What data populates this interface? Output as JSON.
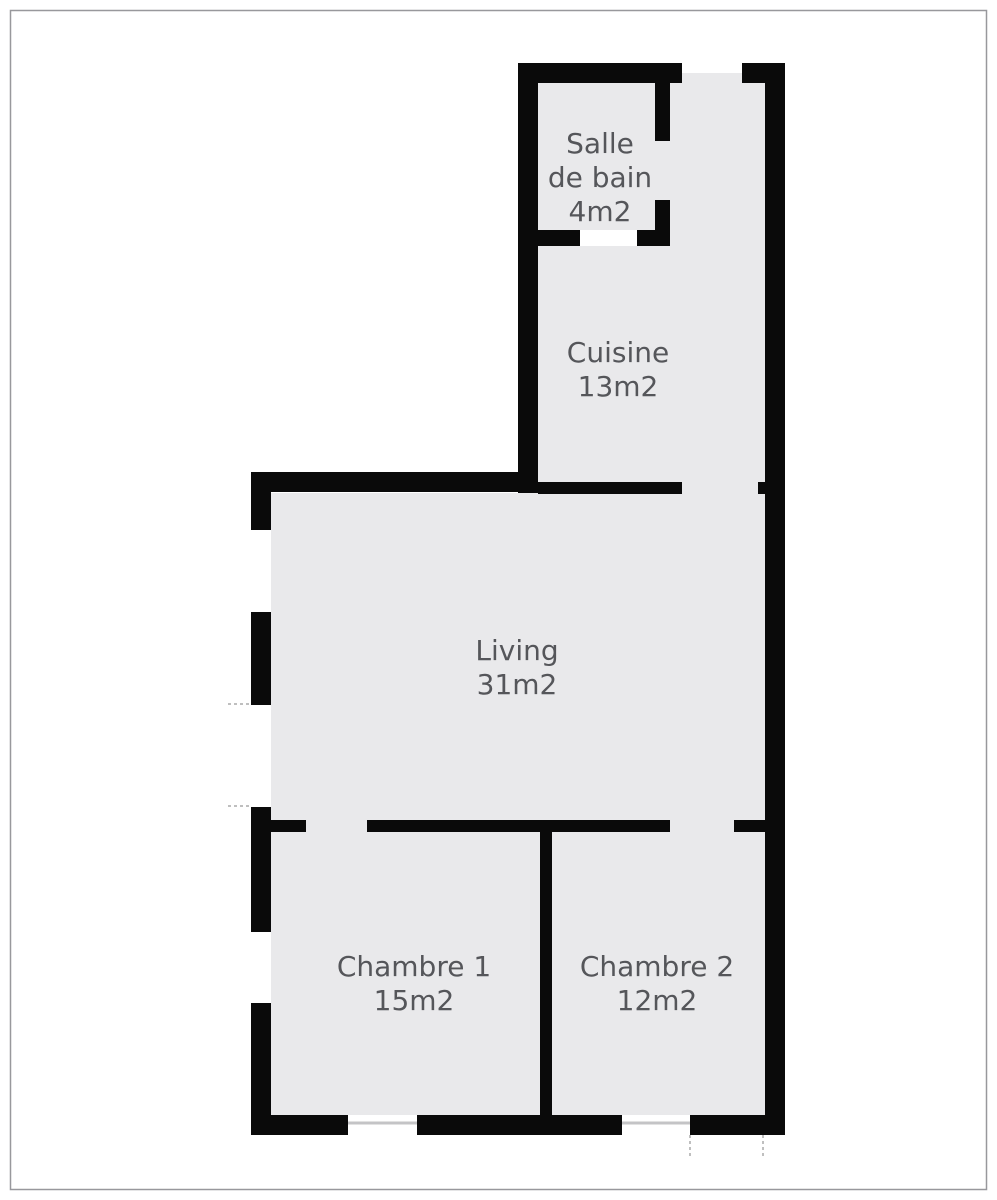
{
  "plan": {
    "type": "apartment-floor-plan",
    "rooms": [
      {
        "name": "Salle de bain",
        "area": "4m2",
        "label_lines": [
          "Salle",
          "de bain",
          "4m2"
        ]
      },
      {
        "name": "Cuisine",
        "area": "13m2",
        "label_lines": [
          "Cuisine",
          "13m2"
        ]
      },
      {
        "name": "Living",
        "area": "31m2",
        "label_lines": [
          "Living",
          "31m2"
        ]
      },
      {
        "name": "Chambre 1",
        "area": "15m2",
        "label_lines": [
          "Chambre 1",
          "15m2"
        ]
      },
      {
        "name": "Chambre 2",
        "area": "12m2",
        "label_lines": [
          "Chambre 2",
          "12m2"
        ]
      }
    ],
    "colors": {
      "wall": "#0a0a0a",
      "floor": "#e9e9eb",
      "label_text": "#55565a",
      "page_frame": "#98989c",
      "window_line": "#c4c4c6",
      "tick_mark": "#aaaaaa",
      "background": "#ffffff"
    }
  }
}
